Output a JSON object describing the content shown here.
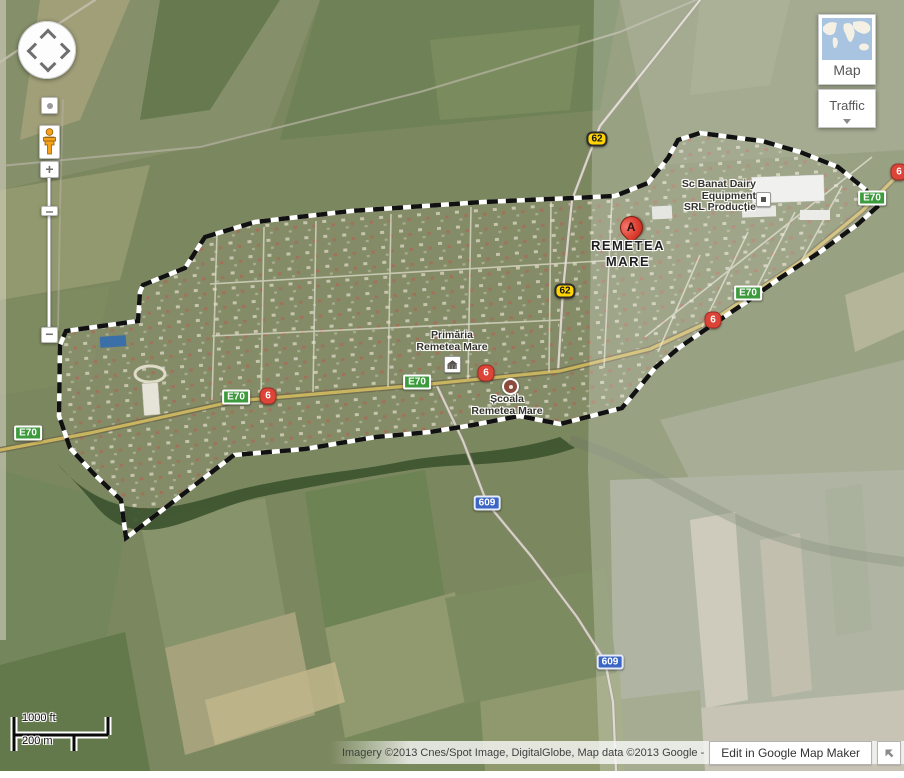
{
  "marker": {
    "label": "A"
  },
  "labels": {
    "town": {
      "line1": "REMETEA",
      "line2": "MARE"
    },
    "primaria": {
      "line1": "Primăria",
      "line2": "Remetea Mare"
    },
    "scoala": {
      "line1": "Școala",
      "line2": "Remetea Mare"
    },
    "banat": {
      "line1": "Sc Banat Dairy",
      "line2": "Equipment",
      "line3": "SRL Producție"
    }
  },
  "shields": [
    {
      "label": "E70",
      "type": "european-route"
    },
    {
      "label": "E70",
      "type": "european-route"
    },
    {
      "label": "E70",
      "type": "european-route"
    },
    {
      "label": "E70",
      "type": "european-route"
    },
    {
      "label": "E70",
      "type": "european-route"
    },
    {
      "label": "6",
      "type": "national-road"
    },
    {
      "label": "6",
      "type": "national-road"
    },
    {
      "label": "6",
      "type": "national-road"
    },
    {
      "label": "6",
      "type": "national-road"
    },
    {
      "label": "62",
      "type": "national-road-yellow"
    },
    {
      "label": "62",
      "type": "national-road-yellow"
    },
    {
      "label": "609",
      "type": "county-road"
    },
    {
      "label": "609",
      "type": "county-road"
    }
  ],
  "controls": {
    "zoom_in": "+",
    "zoom_out": "−"
  },
  "layers": {
    "map_label": "Map",
    "traffic_label": "Traffic"
  },
  "scale": {
    "imperial": "1000 ft",
    "metric": "200 m"
  },
  "attribution": {
    "text": "Imagery ©2013 Cnes/Spot Image, DigitalGlobe, Map data ©2013 Google -",
    "edit_label": "Edit in Google Map Maker"
  },
  "colors": {
    "european_route_green": "#3d9b3d",
    "national_road_red": "#dc4437",
    "national_road_yellow": "#ffd400",
    "county_road_blue": "#3b66c4",
    "marker_red": "#de3b2d",
    "boundary_black": "#111111"
  }
}
